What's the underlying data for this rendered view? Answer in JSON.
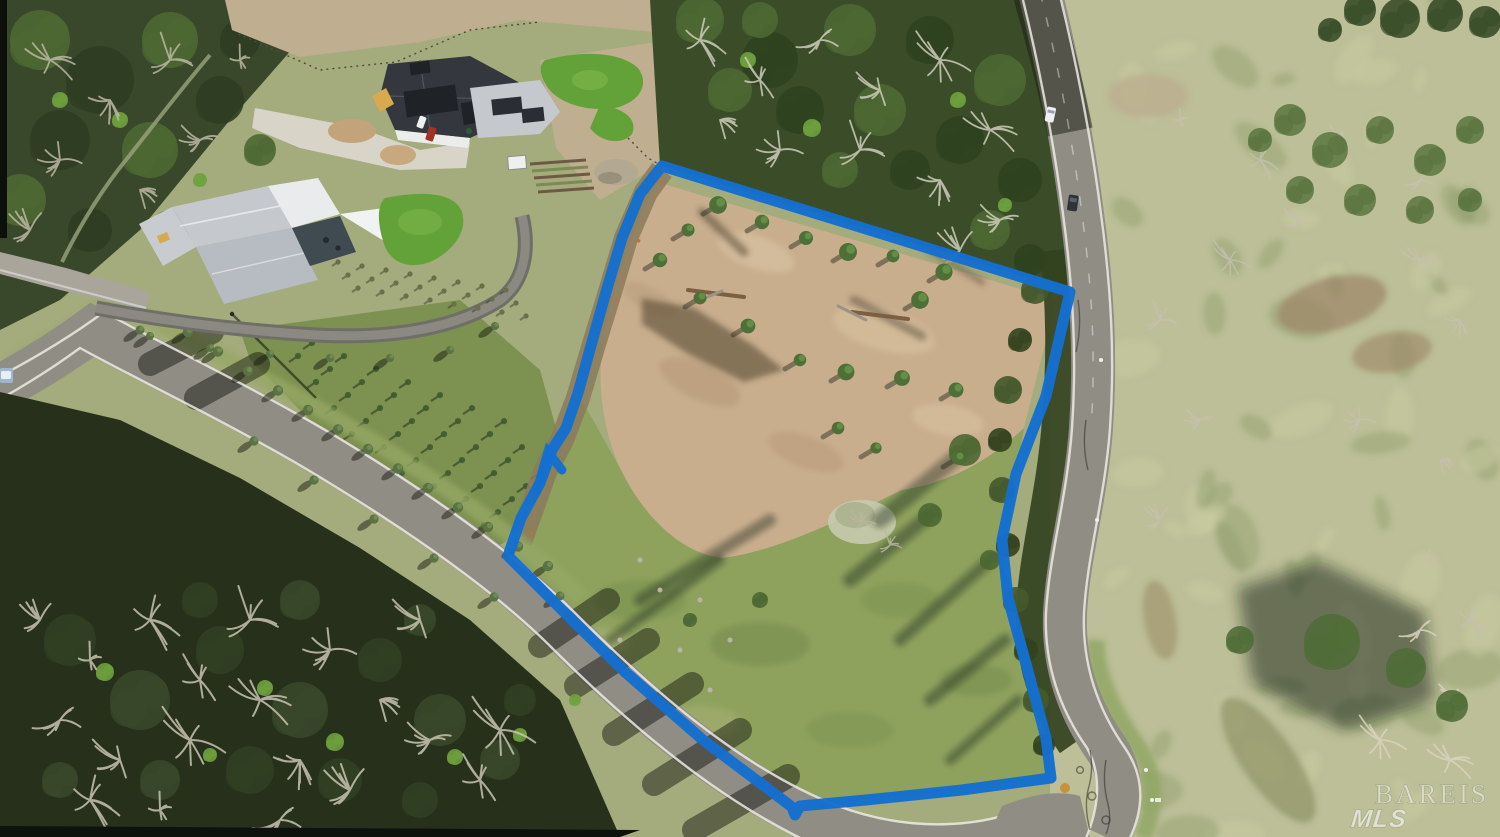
{
  "watermark": {
    "line1": "BAREIS",
    "line2": "MLS"
  },
  "boundary": {
    "color": "#1470cf",
    "stroke_width": 11,
    "points": "662,166 1070,292 1046,396 1016,474 1002,540 1008,598 1026,664 1046,738 1051,778 962,790 866,800 800,806 795,815 792,807 703,740 625,672 560,608 508,556 521,518 540,483 552,450 566,428 578,393 592,342 606,292 622,238 640,194 662,166",
    "overdraw": "562,470 548,452 537,490"
  },
  "palette": {
    "sage": "#a4ab7d",
    "pale": "#bcbf97",
    "pale2": "#c9cca2",
    "grass2": "#8ea25e",
    "grass3": "#93a271",
    "orchard": "#7d9150",
    "canopy": "#4e6833",
    "canopyD": "#33421f",
    "canopyB": "#6fa13f",
    "woodsD": "#26301b",
    "woodsTL": "#39482a",
    "woodsAP": "#3a4c28",
    "dirt": "#c9ae8e",
    "dirtband": "#bfae90",
    "dirtL": "#dbc6a5",
    "dirtD": "#b09272",
    "scrub": "#8b7a5a",
    "road": "#908d85",
    "roadL": "#a7a49c",
    "white": "#eceae2",
    "roofD": "#34373d",
    "roofL": "#c5c9ce",
    "wall": "#ebedec",
    "lawn": "#63a238",
    "concrete": "#d9d4c8",
    "dead": "#c9c4b0",
    "blue": "#1470cf",
    "wm": "rgba(255,255,255,0.45)",
    "wm2": "rgba(255,255,255,0.55)"
  }
}
